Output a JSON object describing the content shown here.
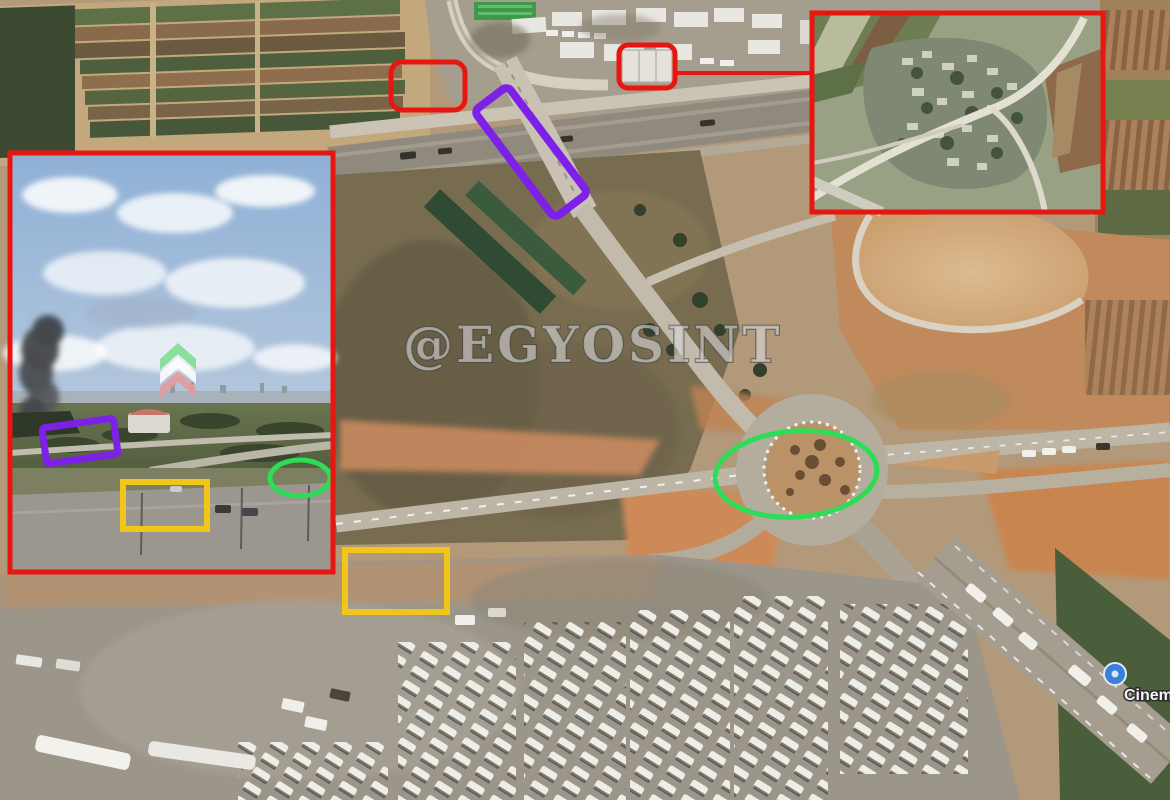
{
  "watermark": {
    "text": "@EGYOSINT"
  },
  "map_pin": {
    "label": "Cinema"
  },
  "colors": {
    "annotation_red": "#e81610",
    "annotation_purple": "#7d20e8",
    "annotation_green": "#2cdd55",
    "annotation_yellow": "#f0c61a",
    "pin_blue": "#3d7fd4"
  },
  "inset_logo": {
    "chevron_top": "#7ddc8f",
    "chevron_middle": "#ffffff",
    "chevron_bottom": "#e89a9a"
  }
}
